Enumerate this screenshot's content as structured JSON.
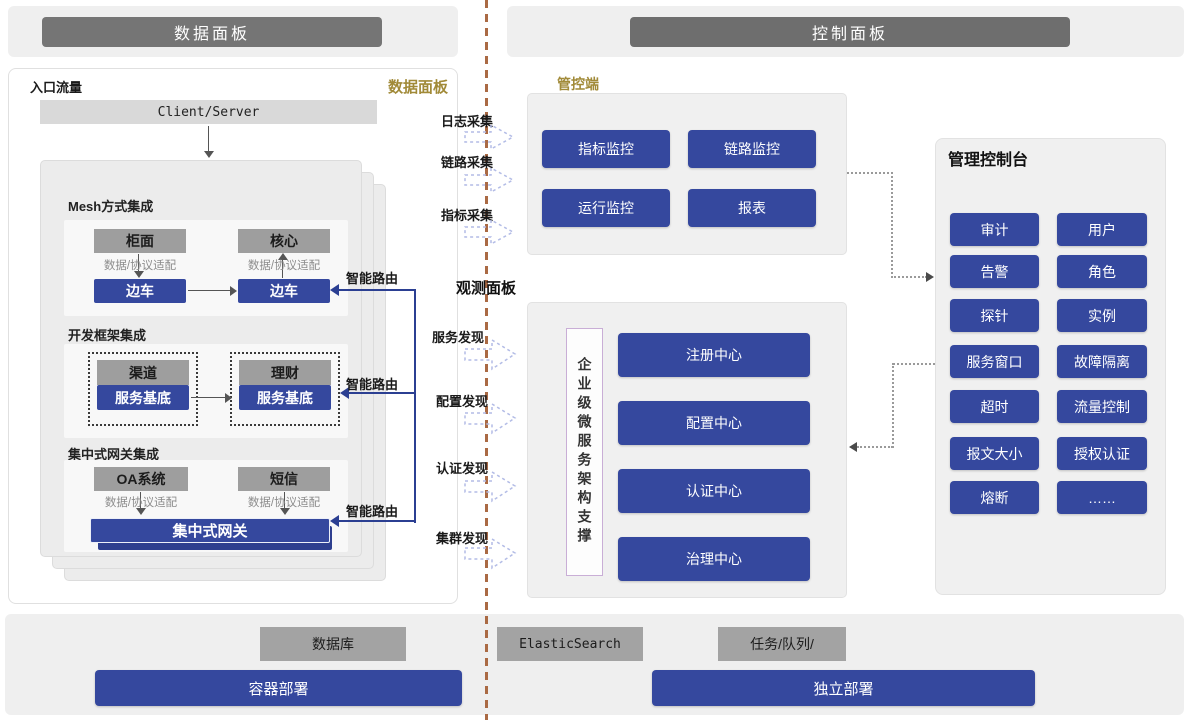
{
  "headers": {
    "data_panel": "数据面板",
    "control_panel": "控制面板"
  },
  "data_panel": {
    "entry_label": "入口流量",
    "corner_label": "数据面板",
    "client_server": "Client/Server",
    "mesh": {
      "title": "Mesh方式集成",
      "app_left": "柜面",
      "app_right": "核心",
      "adapter_left": "数据/协议适配",
      "adapter_right": "数据/协议适配",
      "sidecar_left": "边车",
      "sidecar_right": "边车"
    },
    "framework": {
      "title": "开发框架集成",
      "app_left": "渠道",
      "base_left": "服务基底",
      "app_right": "理财",
      "base_right": "服务基底"
    },
    "gateway": {
      "title": "集中式网关集成",
      "app_left": "OA系统",
      "app_right": "短信",
      "adapter_left": "数据/协议适配",
      "adapter_right": "数据/协议适配",
      "bar": "集中式网关"
    },
    "smart_route": [
      "智能路由",
      "智能路由",
      "智能路由"
    ]
  },
  "flow": {
    "collect": [
      "日志采集",
      "链路采集",
      "指标采集"
    ],
    "observe_label": "观测面板",
    "discover": [
      "服务发现",
      "配置发现",
      "认证发现",
      "集群发现"
    ]
  },
  "control_panel": {
    "manage_label": "管控端",
    "monitors": [
      "指标监控",
      "链路监控",
      "运行监控",
      "报表"
    ],
    "support_label": "企业级微服务架构支撑",
    "centers": [
      "注册中心",
      "配置中心",
      "认证中心",
      "治理中心"
    ],
    "console": {
      "title": "管理控制台",
      "buttons": [
        "审计",
        "用户",
        "告警",
        "角色",
        "探针",
        "实例",
        "服务窗口",
        "故障隔离",
        "超时",
        "流量控制",
        "报文大小",
        "授权认证",
        "熔断",
        "……"
      ]
    }
  },
  "infrastructure": {
    "database": "数据库",
    "search": "ElasticSearch",
    "queue": "任务/队列/",
    "deploy_left": "容器部署",
    "deploy_right": "独立部署"
  },
  "colors": {
    "node_blue": "#35489e",
    "node_gray": "#9e9e9e",
    "header_bar_gray": "#757575",
    "gold_label": "#a18a38",
    "divider_brown": "#aa6a44",
    "route_blue": "#2b3f92",
    "flow_arrow": "#b3bce6"
  }
}
